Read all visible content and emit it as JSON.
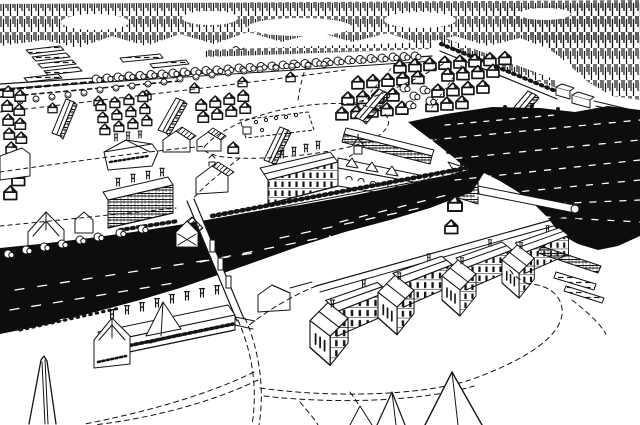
{
  "meta": {
    "type": "pen-and-ink bird's-eye engraving",
    "title": "Bird's-eye view of a riverside armory settlement",
    "description": "Hand-drawn aerial perspective illustration: forest along the horizon, cultivated field strips, rows of cottages and a grid of workers' huts, long barracks, a central armory workshop complex, a dark river and power canal crossed by a bridge with a covered gatehouse, riverside mills with tall chimneys, a row of large factory blocks, a black harbor with piers and timber floats, dashed country roads looping through the foreground, and an obelisk monument at lower left."
  },
  "palette": {
    "paper": "#ffffff",
    "ink": "#141414",
    "water": "#0d0d0d"
  },
  "regions": [
    {
      "id": "forest-treeline",
      "label": "Forest tree line along the horizon"
    },
    {
      "id": "field-strips",
      "label": "Cultivated field strips"
    },
    {
      "id": "stockade",
      "label": "Stockade wall and waterfront sheds"
    },
    {
      "id": "cottage-tree-row",
      "label": "Tree-lined road with cottages"
    },
    {
      "id": "hut-grid",
      "label": "Grid of workers' huts"
    },
    {
      "id": "left-hut-column",
      "label": "Column of huts at the left edge"
    },
    {
      "id": "barracks",
      "label": "Long barracks buildings"
    },
    {
      "id": "village-houses",
      "label": "Village houses and workshops with chimneys"
    },
    {
      "id": "garden",
      "label": "Fenced garden plot on the common"
    },
    {
      "id": "upper-roads",
      "label": "Dashed roads around the common"
    },
    {
      "id": "armory",
      "label": "Central armory workshop complex"
    },
    {
      "id": "waterway",
      "label": "River, power canal and harbor water"
    },
    {
      "id": "canal-wall",
      "label": "Canal embankment wall"
    },
    {
      "id": "bridge",
      "label": "Bridge with covered gatehouse"
    },
    {
      "id": "riverside-mill",
      "label": "Riverside mill with tall chimneys"
    },
    {
      "id": "factory-row",
      "label": "Row of large factory blocks along the street"
    },
    {
      "id": "piers",
      "label": "Harbor piers and wharf"
    },
    {
      "id": "boats",
      "label": "Timber floats by the wharf"
    },
    {
      "id": "foreground-roads",
      "label": "Looping dashed roads in the foreground"
    },
    {
      "id": "bottom-gables",
      "label": "Roof gables entering the lower edge"
    },
    {
      "id": "obelisk",
      "label": "Obelisk monument"
    },
    {
      "id": "bushes",
      "label": "Bushes along the river bank"
    }
  ]
}
